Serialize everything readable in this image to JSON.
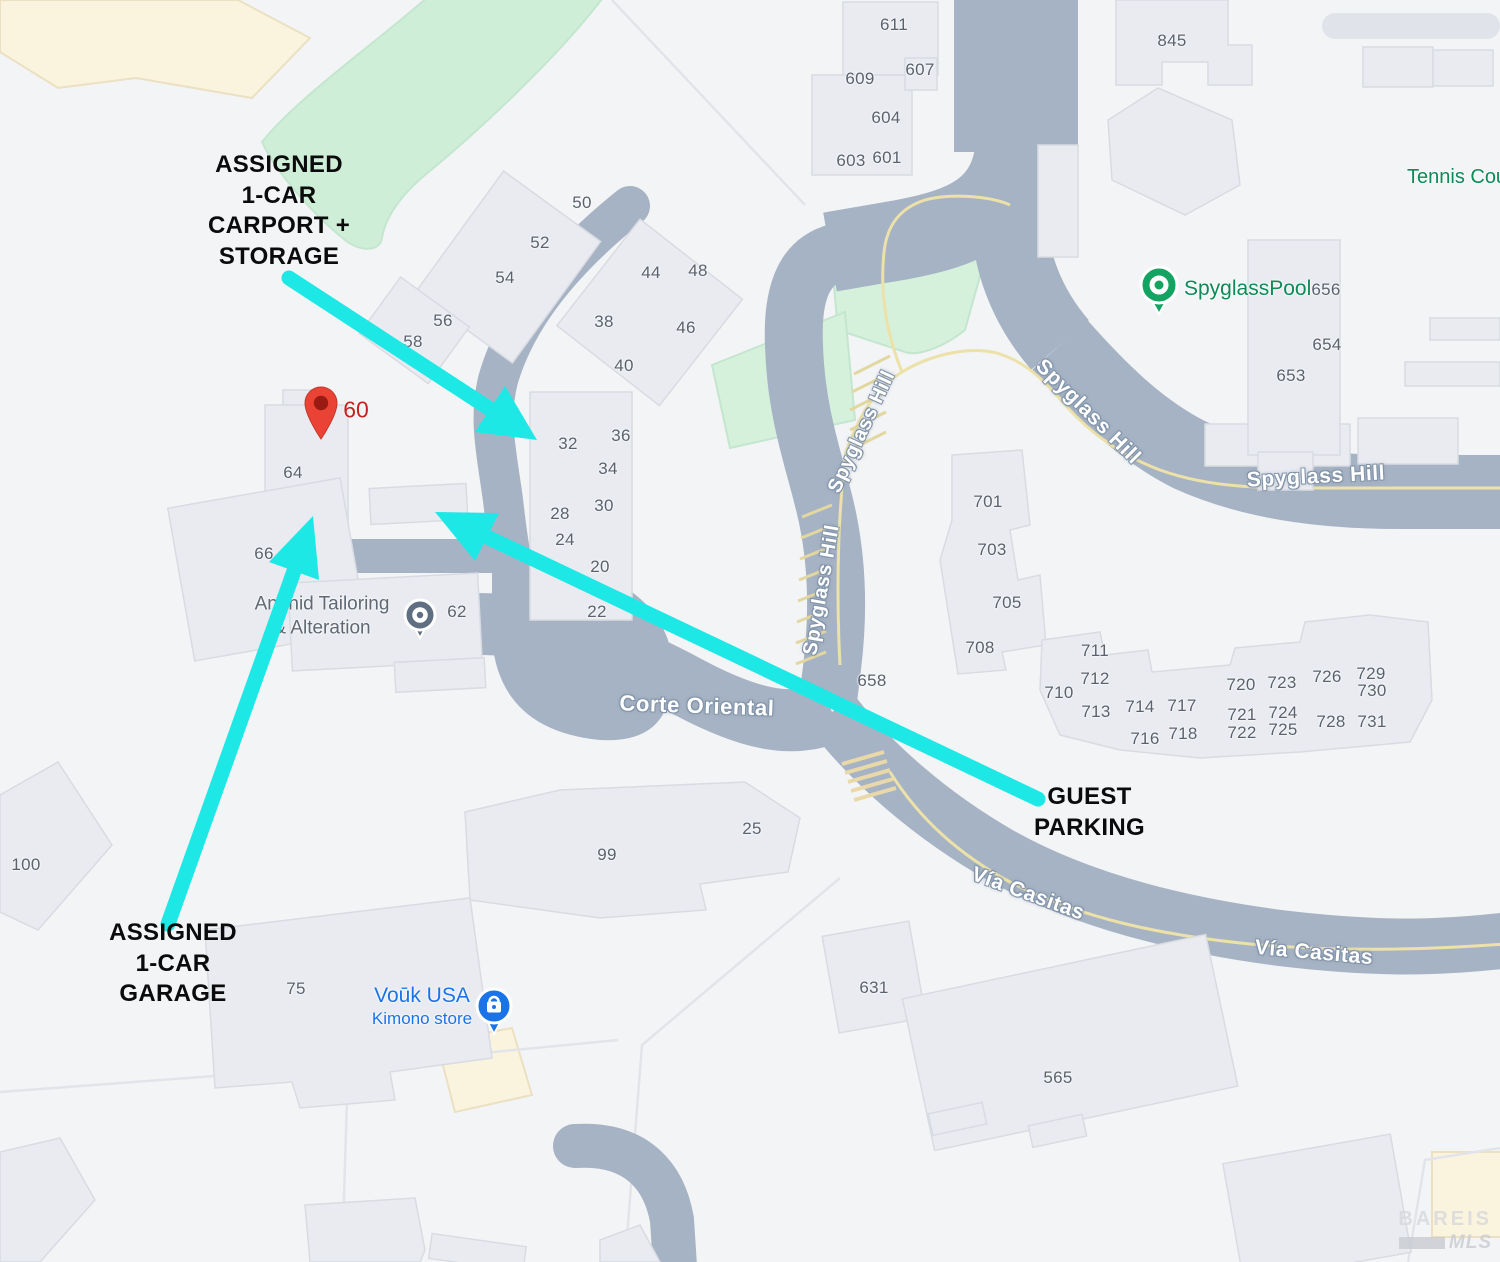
{
  "colors": {
    "background": "#f3f4f6",
    "road": "#a6b3c4",
    "building": "#e9ebf0",
    "building_border": "#d8dbe1",
    "green_area": "#d5f1dc",
    "cream_area": "#faf3de",
    "yellow_line": "#ece1a8",
    "arrow_cyan": "#1ee8e6",
    "pin_red": "#ea4335",
    "pin_red_dark": "#991b12",
    "poi_green": "#15a362",
    "poi_blue": "#1a73e8",
    "street_text": "#ffffff",
    "number_text": "#5a626e"
  },
  "annotations": {
    "carport": {
      "text": "ASSIGNED\n1-CAR\nCARPORT +\nSTORAGE"
    },
    "garage": {
      "text": "ASSIGNED\n1-CAR\nGARAGE"
    },
    "guest": {
      "text": "GUEST\nPARKING"
    }
  },
  "pin": {
    "label": "60"
  },
  "pois": {
    "pool": {
      "name": "SpyglassPool"
    },
    "tennis": {
      "name": "Tennis Cou"
    },
    "tailor": {
      "name": "Anahid Tailoring\n& Alteration"
    },
    "kimono": {
      "name": "Voūk USA",
      "sub": "Kimono store"
    }
  },
  "streets": [
    {
      "label": "Spyglass Hill",
      "x": 1088,
      "y": 412,
      "rot": 45,
      "size": 21
    },
    {
      "label": "Spyglass Hill",
      "x": 1316,
      "y": 477,
      "rot": -3,
      "size": 21
    },
    {
      "label": "Spyglass Hill",
      "x": 862,
      "y": 432,
      "rot": -65,
      "size": 20
    },
    {
      "label": "Spyglass Hill",
      "x": 822,
      "y": 590,
      "rot": -80,
      "size": 20
    },
    {
      "label": "Corte Oriental",
      "x": 697,
      "y": 706,
      "rot": 2,
      "size": 22
    },
    {
      "label": "Vía Casitas",
      "x": 1028,
      "y": 894,
      "rot": 20,
      "size": 21
    },
    {
      "label": "Vía Casitas",
      "x": 1314,
      "y": 953,
      "rot": 5,
      "size": 21
    }
  ],
  "house_numbers": [
    {
      "n": "611",
      "x": 894,
      "y": 25
    },
    {
      "n": "609",
      "x": 860,
      "y": 79
    },
    {
      "n": "607",
      "x": 920,
      "y": 70
    },
    {
      "n": "604",
      "x": 886,
      "y": 118
    },
    {
      "n": "603",
      "x": 851,
      "y": 161
    },
    {
      "n": "601",
      "x": 887,
      "y": 158
    },
    {
      "n": "845",
      "x": 1172,
      "y": 41
    },
    {
      "n": "50",
      "x": 582,
      "y": 203
    },
    {
      "n": "52",
      "x": 540,
      "y": 243
    },
    {
      "n": "54",
      "x": 505,
      "y": 278
    },
    {
      "n": "56",
      "x": 443,
      "y": 321
    },
    {
      "n": "58",
      "x": 413,
      "y": 342
    },
    {
      "n": "44",
      "x": 651,
      "y": 273
    },
    {
      "n": "48",
      "x": 698,
      "y": 271
    },
    {
      "n": "38",
      "x": 604,
      "y": 322
    },
    {
      "n": "46",
      "x": 686,
      "y": 328
    },
    {
      "n": "40",
      "x": 624,
      "y": 366
    },
    {
      "n": "32",
      "x": 568,
      "y": 444
    },
    {
      "n": "36",
      "x": 621,
      "y": 436
    },
    {
      "n": "34",
      "x": 608,
      "y": 469
    },
    {
      "n": "30",
      "x": 604,
      "y": 506
    },
    {
      "n": "28",
      "x": 560,
      "y": 514
    },
    {
      "n": "24",
      "x": 565,
      "y": 540
    },
    {
      "n": "20",
      "x": 600,
      "y": 567
    },
    {
      "n": "22",
      "x": 597,
      "y": 612
    },
    {
      "n": "64",
      "x": 293,
      "y": 473
    },
    {
      "n": "66",
      "x": 264,
      "y": 554
    },
    {
      "n": "62",
      "x": 457,
      "y": 612
    },
    {
      "n": "656",
      "x": 1326,
      "y": 290
    },
    {
      "n": "654",
      "x": 1327,
      "y": 345
    },
    {
      "n": "653",
      "x": 1291,
      "y": 376
    },
    {
      "n": "701",
      "x": 988,
      "y": 502
    },
    {
      "n": "703",
      "x": 992,
      "y": 550
    },
    {
      "n": "705",
      "x": 1007,
      "y": 603
    },
    {
      "n": "708",
      "x": 980,
      "y": 648
    },
    {
      "n": "658",
      "x": 872,
      "y": 681
    },
    {
      "n": "711",
      "x": 1095,
      "y": 651
    },
    {
      "n": "712",
      "x": 1095,
      "y": 679
    },
    {
      "n": "710",
      "x": 1059,
      "y": 693
    },
    {
      "n": "713",
      "x": 1096,
      "y": 712
    },
    {
      "n": "714",
      "x": 1140,
      "y": 707
    },
    {
      "n": "717",
      "x": 1182,
      "y": 706
    },
    {
      "n": "716",
      "x": 1145,
      "y": 739
    },
    {
      "n": "718",
      "x": 1183,
      "y": 734
    },
    {
      "n": "720",
      "x": 1241,
      "y": 685
    },
    {
      "n": "721",
      "x": 1242,
      "y": 715
    },
    {
      "n": "722",
      "x": 1242,
      "y": 733
    },
    {
      "n": "723",
      "x": 1282,
      "y": 683
    },
    {
      "n": "724",
      "x": 1283,
      "y": 713
    },
    {
      "n": "725",
      "x": 1283,
      "y": 730
    },
    {
      "n": "726",
      "x": 1327,
      "y": 677
    },
    {
      "n": "728",
      "x": 1331,
      "y": 722
    },
    {
      "n": "729",
      "x": 1371,
      "y": 674
    },
    {
      "n": "730",
      "x": 1372,
      "y": 691
    },
    {
      "n": "731",
      "x": 1372,
      "y": 722
    },
    {
      "n": "100",
      "x": 26,
      "y": 865
    },
    {
      "n": "75",
      "x": 296,
      "y": 989
    },
    {
      "n": "99",
      "x": 607,
      "y": 855
    },
    {
      "n": "25",
      "x": 752,
      "y": 829
    },
    {
      "n": "631",
      "x": 874,
      "y": 988
    },
    {
      "n": "565",
      "x": 1058,
      "y": 1078
    }
  ],
  "watermark": {
    "line1": "BAREIS",
    "line2": "MLS"
  }
}
